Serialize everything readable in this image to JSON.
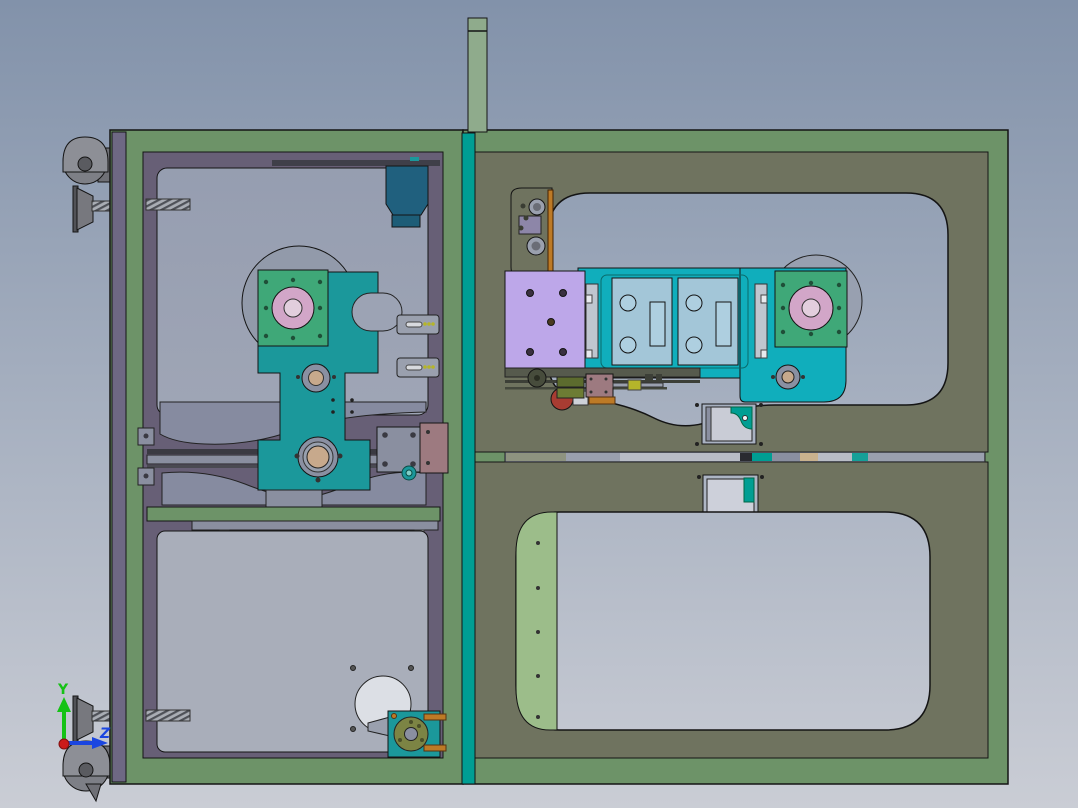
{
  "viewport": {
    "description": "CAD shaded-with-edges side view of industrial machine frame assembly",
    "triad": {
      "y_label": "Y",
      "z_label": "Z"
    }
  },
  "colors": {
    "bgTop": "#8292aa",
    "bgBottom": "#cacdd5",
    "outline": "#141414",
    "frameGreen": "#6d9368",
    "postGreen": "#8fab8c",
    "violetEdge": "#6e6884",
    "purpleFrame": "#675f76",
    "panelTop": "#959db0",
    "panelBottom": "#adb1bd",
    "panelLower": "#a9aeba",
    "olivePanel": "#6f735f",
    "lightGreen": "#9cbd8a",
    "tealStrip": "#009e93",
    "tealMech": "#1b989b",
    "tealMechR": "#10aebc",
    "greenPlate": "#3fa878",
    "pinkHub": "#d2a6c8",
    "pinkHubInner": "#e2cedd",
    "lavenderPlate": "#bda7e9",
    "bluePlate": "#a3c6d8",
    "dkTealBox": "#20607e",
    "mauvePlate": "#9d7a80",
    "grayMech": "#868ba0",
    "tanBearing": "#c7a98c",
    "oliveSprocket": "#7c8444",
    "orangeAccent": "#bd7a26",
    "redAccent": "#a83c32",
    "casterGray": "#7d7f86",
    "axisY": "#15c215",
    "axisZ": "#1b46e0",
    "axisOrigin": "#cc1a1a"
  }
}
